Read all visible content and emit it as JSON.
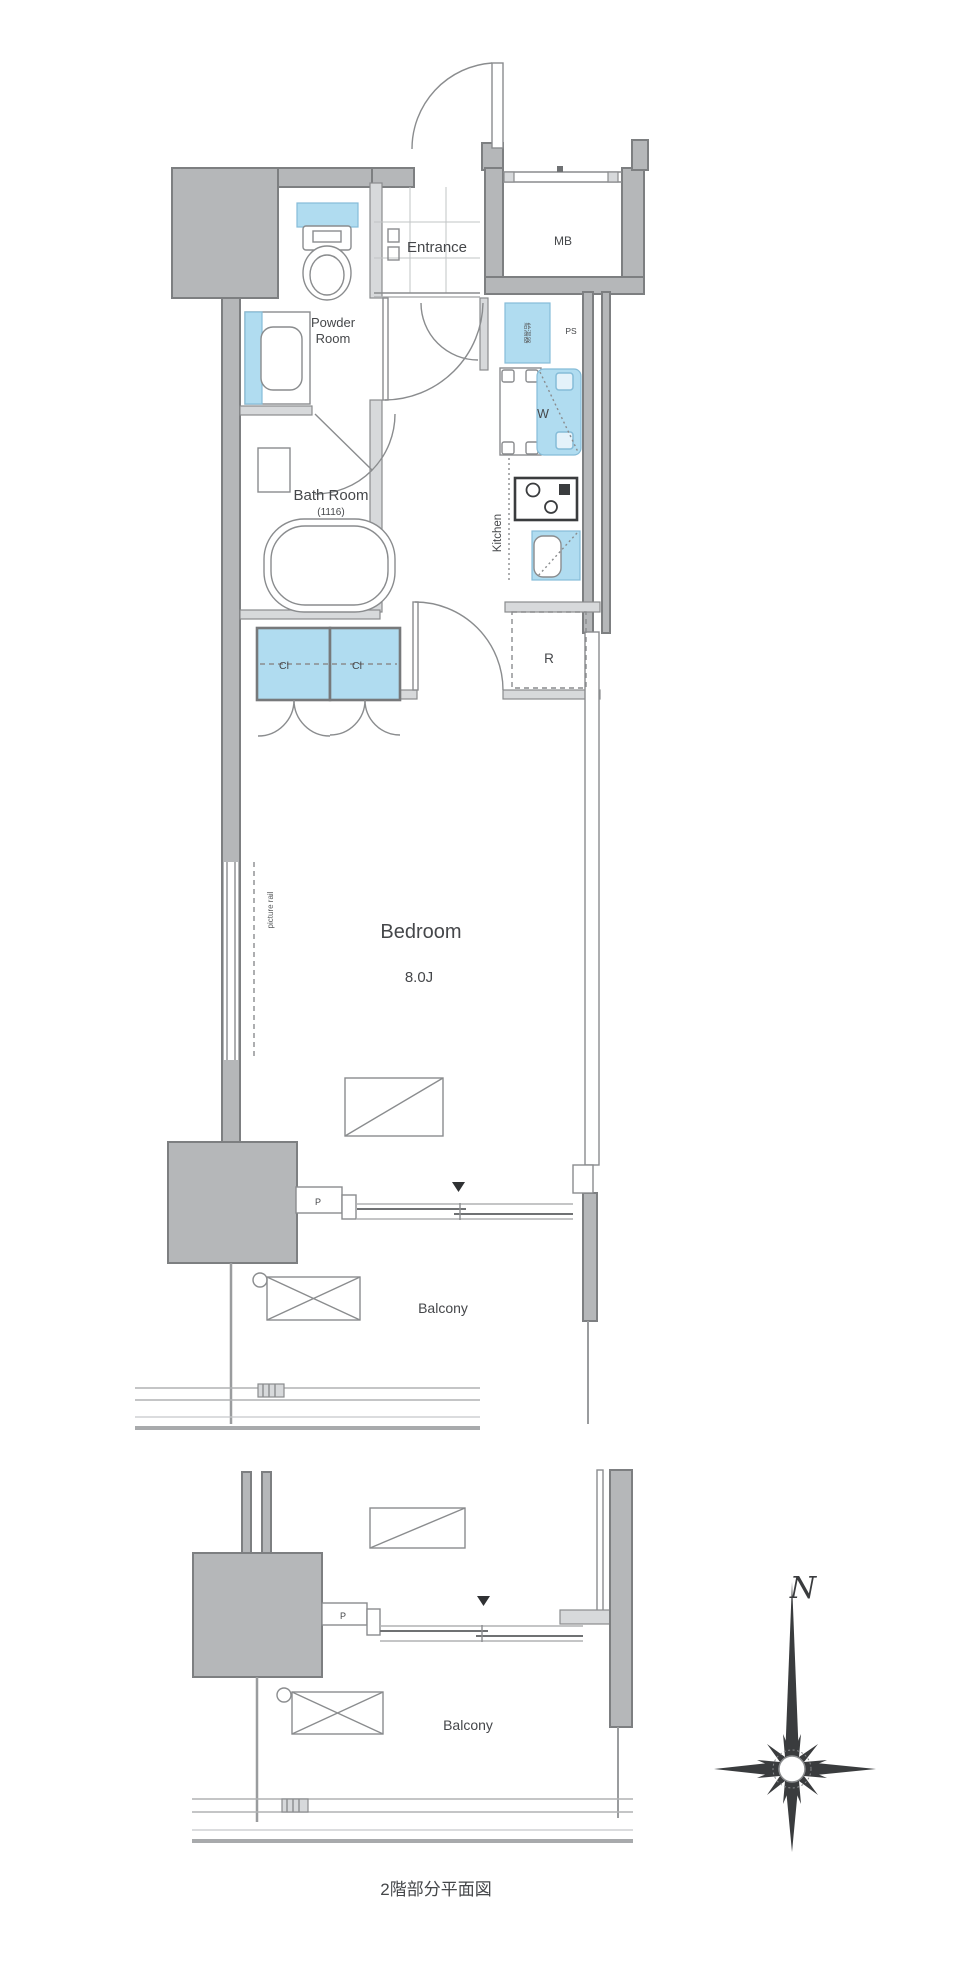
{
  "labels": {
    "entrance": "Entrance",
    "meter_box": "MB",
    "pipe_shaft": "PS",
    "water_heater": "給湯器",
    "washer": "W",
    "kitchen": "Kitchen",
    "powder_room_line1": "Powder",
    "powder_room_line2": "Room",
    "bath_room": "Bath Room",
    "bath_room_size": "(1116)",
    "closet_left": "Cl",
    "closet_right": "Cl",
    "refrigerator": "R",
    "bedroom": "Bedroom",
    "bedroom_size": "8.0J",
    "picture_rail": "picture rail",
    "pipe_space": "P",
    "balcony": "Balcony"
  },
  "second_floor": {
    "pipe_space": "P",
    "balcony": "Balcony",
    "caption": "2階部分平面図"
  },
  "compass": {
    "north": "N"
  },
  "colors": {
    "wall_gray": "#b5b7b9",
    "line_gray": "#8a8c8e",
    "fixture_blue": "#b0dcf0",
    "text": "#45474a"
  }
}
